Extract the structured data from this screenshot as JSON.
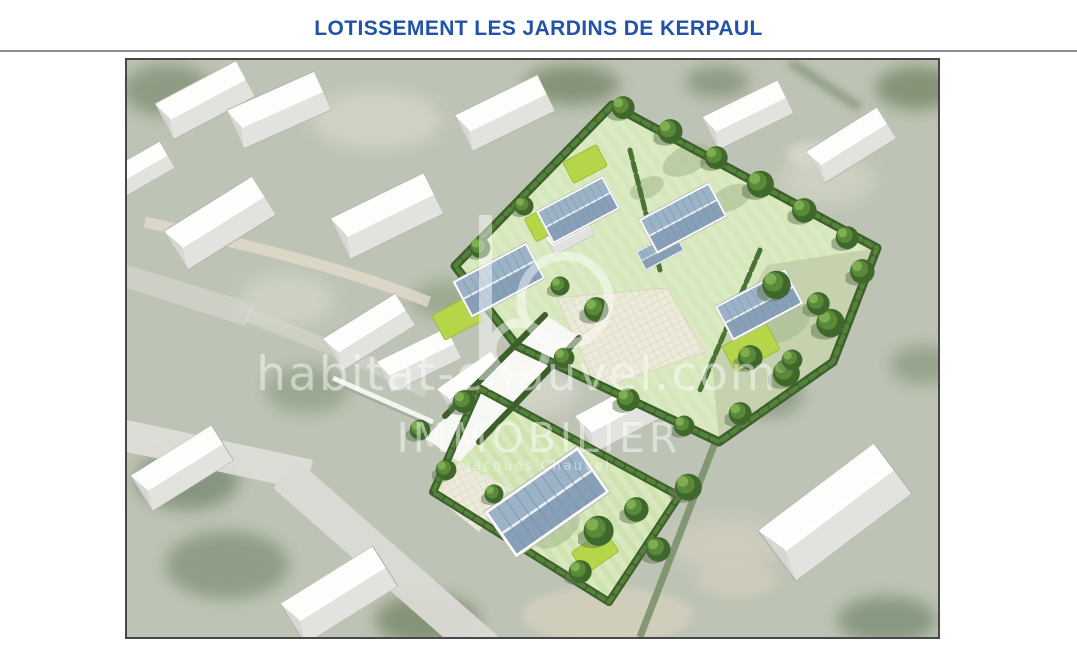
{
  "header": {
    "title": "LOTISSEMENT LES JARDINS DE KERPAUL"
  },
  "rendering": {
    "description": "aerial-3d-view-of-housing-development",
    "watermark": {
      "site_url": "habitat-chauvel.com",
      "brand": "IMMOBILIER",
      "tagline": "Jacques Chauvel"
    },
    "colors": {
      "title_blue": "#2153a8",
      "rule_gray": "#8f8f8f",
      "frame_border": "#474747",
      "photo_base": "#b6bdab",
      "lawn_green": "#dcebc4",
      "lime_green": "#b5d649",
      "hedge_green": "#3c5f2b",
      "new_roof_blue": "#8fa7bd",
      "existing_roof_white": "#fdfdfc",
      "watermark_white": "#ffffff"
    }
  }
}
